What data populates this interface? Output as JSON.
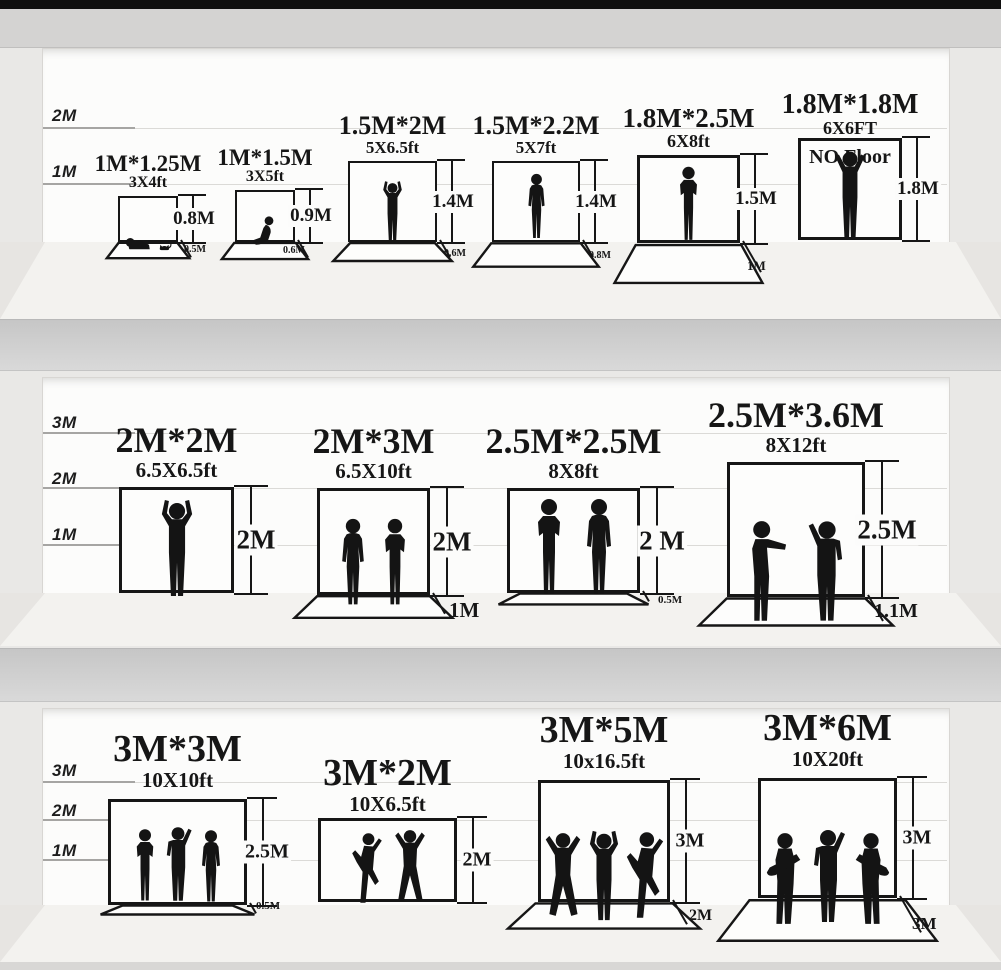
{
  "colors": {
    "ink": "#161616",
    "wall": "#fcfcfb",
    "floor": "#f3f2ef",
    "shelf_divider": "#d0d0d0",
    "top_bar": "#0f0f0f",
    "background": "#e9e8e6"
  },
  "rows": [
    {
      "name": "row-1",
      "scale": [
        "2M",
        "1M"
      ],
      "items": [
        {
          "title": "1M*1.25M",
          "subtitle": "3X4ft",
          "height": "0.8M",
          "floor": "0.5M"
        },
        {
          "title": "1M*1.5M",
          "subtitle": "3X5ft",
          "height": "0.9M",
          "floor": "0.6M"
        },
        {
          "title": "1.5M*2M",
          "subtitle": "5X6.5ft",
          "height": "1.4M",
          "floor": "0.6M"
        },
        {
          "title": "1.5M*2.2M",
          "subtitle": "5X7ft",
          "height": "1.4M",
          "floor": "0.8M"
        },
        {
          "title": "1.8M*2.5M",
          "subtitle": "6X8ft",
          "height": "1.5M",
          "floor": "1M"
        },
        {
          "title": "1.8M*1.8M",
          "subtitle": "6X6FT",
          "height": "1.8M",
          "note": "NO Floor"
        }
      ]
    },
    {
      "name": "row-2",
      "scale": [
        "3M",
        "2M",
        "1M"
      ],
      "items": [
        {
          "title": "2M*2M",
          "subtitle": "6.5X6.5ft",
          "height": "2M"
        },
        {
          "title": "2M*3M",
          "subtitle": "6.5X10ft",
          "height": "2M",
          "floor": "1M"
        },
        {
          "title": "2.5M*2.5M",
          "subtitle": "8X8ft",
          "height": "2 M",
          "floor": "0.5M"
        },
        {
          "title": "2.5M*3.6M",
          "subtitle": "8X12ft",
          "height": "2.5M",
          "floor": "1.1M"
        }
      ]
    },
    {
      "name": "row-3",
      "scale": [
        "3M",
        "2M",
        "1M"
      ],
      "items": [
        {
          "title": "3M*3M",
          "subtitle": "10X10ft",
          "height": "2.5M",
          "floor": "0.5M"
        },
        {
          "title": "3M*2M",
          "subtitle": "10X6.5ft",
          "height": "2M"
        },
        {
          "title": "3M*5M",
          "subtitle": "10x16.5ft",
          "height": "3M",
          "floor": "2M"
        },
        {
          "title": "3M*6M",
          "subtitle": "10X20ft",
          "height": "3M",
          "floor": "3M"
        }
      ]
    }
  ]
}
